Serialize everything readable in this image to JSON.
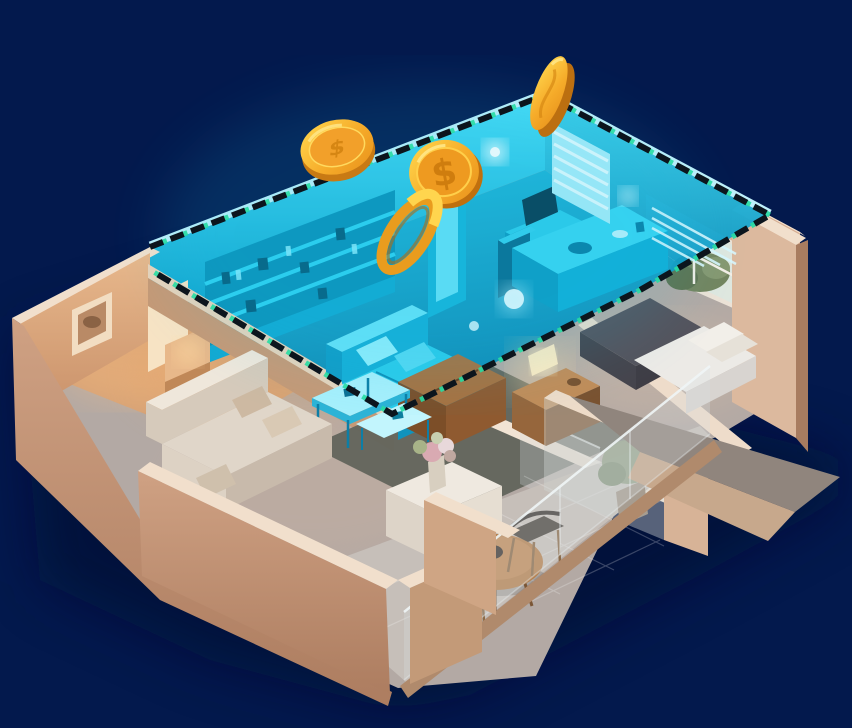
{
  "scene": {
    "type": "isometric-apartment-cutaway-illustration",
    "background_color": "#03194d",
    "shadow_color": "#020e33",
    "regions": [
      "highlighted-share-zone",
      "living-room",
      "entry-hall",
      "bedroom",
      "kitchenette",
      "study-nook",
      "dining-area",
      "balcony"
    ]
  },
  "highlight": {
    "zone_color": "#1cc1e4",
    "zone_wall_color": "#2ad0f1",
    "zone_pale_color": "#bff0fa",
    "zone_deep_color": "#0d93bd",
    "boundary_style": "dashed",
    "boundary_dash_color": "#0c151d",
    "boundary_accent_color": "#27dba2"
  },
  "coins": {
    "symbol": "$",
    "count": 4,
    "face_color": "#f3a224",
    "rim_color": "#ffd24a",
    "edge_color": "#c07312",
    "highlight_color": "#ffe98c"
  },
  "apartment": {
    "wall_color": "#d6ae93",
    "wall_top_color": "#f1dfcc",
    "wall_shadow_color": "#b0805f",
    "warm_light_color": "#ffc080",
    "floor_color": "#b3a9a4",
    "tile_color": "#c6bfb9",
    "rug_color": "#62645c",
    "wood_color": "#b5804e",
    "leather_color": "#a06a3c",
    "cream_sofa_color": "#e0d6c9",
    "bed_blanket_color": "#55535c",
    "bed_linen_color": "#eceae6",
    "glass_color": "#d7e0e2",
    "plant_color": "#74855f"
  }
}
